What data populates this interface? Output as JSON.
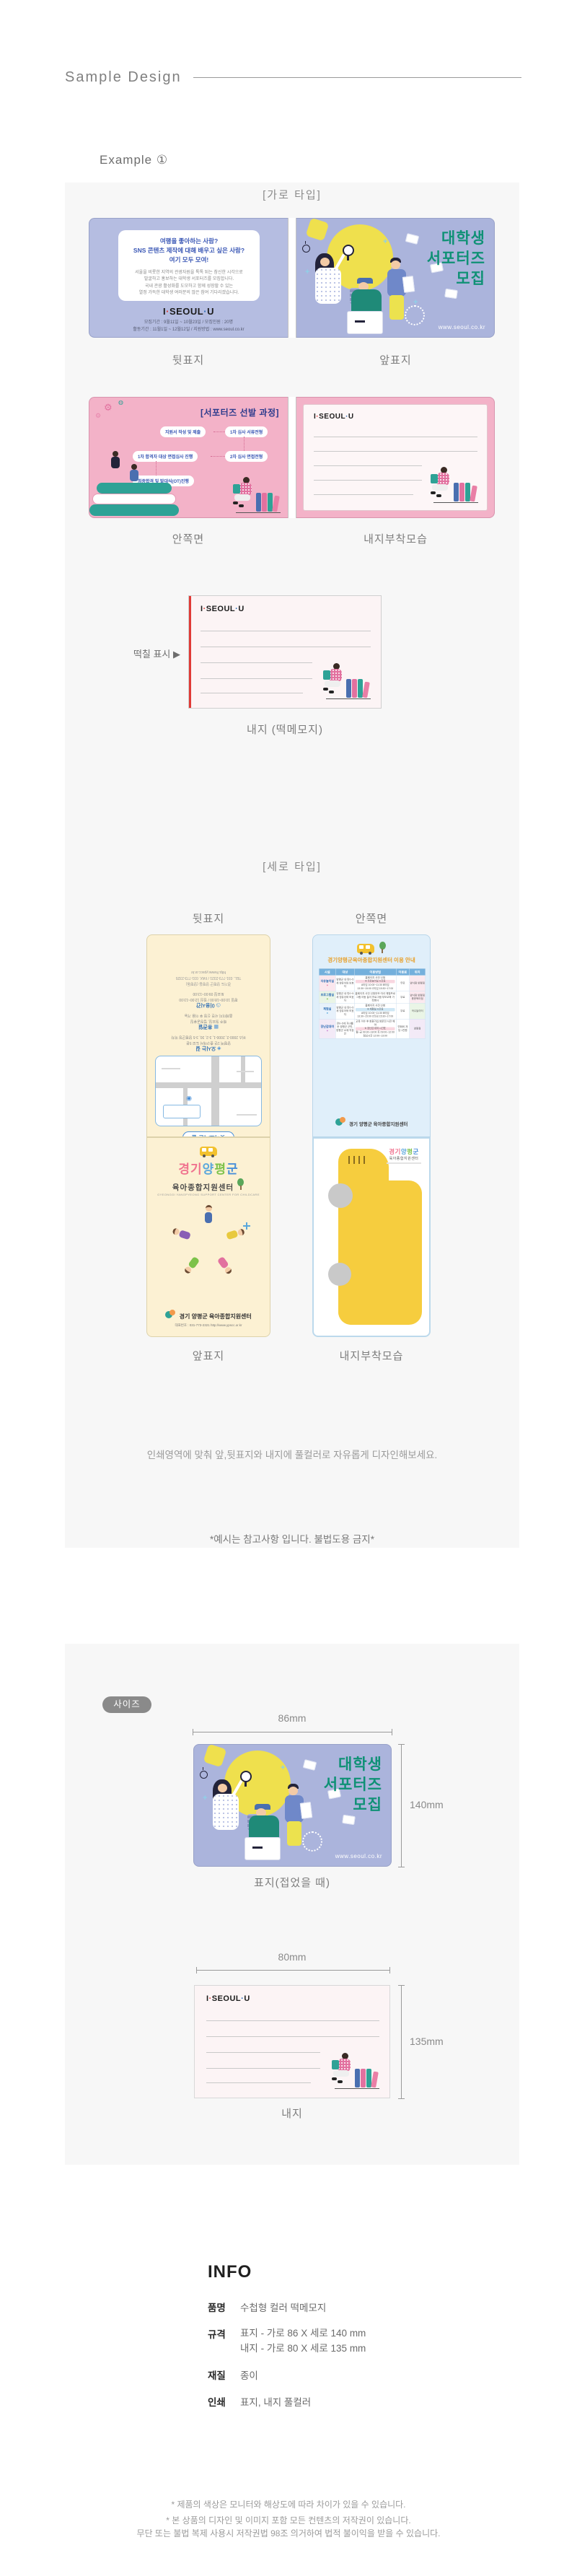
{
  "colors": {
    "panel": "#f7f7f7",
    "lavender-back": "#b5bde1",
    "lavender-front": "#abb4dc",
    "green-title": "#0f9175",
    "blue-heading": "#3a57b5",
    "navy-title": "#2b3a8c",
    "pink-card": "#f3b2c8",
    "pink-deep": "#e2719f",
    "cream-card": "#fcf1d3",
    "lightblue-card": "#e0effa",
    "table-header": "#74b0dc",
    "yellow-sticky": "#f6cd3e",
    "yellow-bulb": "#efe04d",
    "red-mark": "#e03a36",
    "orange-title": "#e8a029",
    "badge-gray": "#8a8a8a",
    "blue-dot": "#2b6cb5"
  },
  "header": {
    "title": "Sample Design"
  },
  "example": {
    "label": "Example ①"
  },
  "sections": {
    "horizontal_label": "[가로 타입]",
    "vertical_label": "[세로 타입]"
  },
  "captions": {
    "back_cover": "뒷표지",
    "front_cover": "앞표지",
    "inside": "안쪽면",
    "attached": "내지부착모습",
    "memo_note": "내지 (떡메모지)",
    "glue_mark": "떡칠 표시 ▶",
    "v_back_cover": "뒷표지",
    "v_inside": "안쪽면",
    "v_front_cover": "앞표지",
    "v_attached": "내지부착모습",
    "cover_folded": "표지(접었을 때)",
    "inner_sheet": "내지"
  },
  "seoul": {
    "logo_parts": {
      "i": "I",
      "seoul": "SEOUL",
      "u": "U"
    },
    "back_heading_lines": [
      "여행을 좋아하는 사람?",
      "SNS 콘텐츠 제작에 대해 배우고 싶은 사람?",
      "여기 모두 모여!"
    ],
    "back_body_lines": [
      "서울을 비롯한 지역의 관광자원을 톡톡 튀는 참신한 시각으로",
      "발굴하고 홍보하는 대학생 서포터즈를 모집합니다.",
      "국내 관광 활성화를 도모하고 함께 성장할 수 있는",
      "열정 가득한 대학생 여러분의 많은 참여 기다리겠습니다."
    ],
    "back_meta_lines": [
      "모집기간 : 9월11일 ~ 10월23일 / 모집인원 : 20명",
      "활동기간 : 11월1일 ~ 12월12일 / 지원방법 : www.seoul.co.kr"
    ],
    "front_title_lines": [
      "대학생",
      "서포터즈",
      "모집"
    ],
    "front_url": "www.seoul.co.kr",
    "process_title": "[서포터즈 선발 과정]",
    "process_steps": [
      "지원서 작성 및 제출",
      "1차 심사 서류전형",
      "1차 합격자 대상 면접심사 진행",
      "2차 심사 면접전형",
      "최종합격 및 발대식(OT)진행"
    ]
  },
  "yangpyeong": {
    "map_title": "찾아오시는 길",
    "guide_sections": [
      {
        "icon": "◈",
        "title": "오시는 길",
        "lines": [
          "양평역 1번 출구에서 도보 5분",
          "버스 2000-2, 2000-1, 3-2, 30, 3-5 양평군청 하차"
        ]
      },
      {
        "icon": "▦",
        "title": "휴관일",
        "lines": [
          "매주 월요일, 법정공휴일",
          "홈페이지 사전 신청 후 이용 가능"
        ]
      },
      {
        "icon": "◷",
        "title": "이용시간",
        "lines": [
          "평일 10:00~18:00 / 점심 12:00~13:00",
          "토요일 09:00~13:00"
        ]
      }
    ],
    "contact_lines": [
      "경기도 양평군 양평읍 (양평동)",
      "TEL. 031-773-2321 / FAX. 031-773-2325",
      "http://www.ypscc.or.kr"
    ],
    "title_parts": {
      "p1": "경기",
      "p2": "양",
      "p3": "평",
      "p4": "군"
    },
    "subtitle": "육아종합지원센터",
    "subtitle_en": "GYEONGGI YANGPYEONG SUPPORT CENTER FOR CHILDCARE",
    "logo_name": "경기 양평군 육아종합지원센터",
    "logo_contact": "대표번호 : 031-773-2321   http://www.ypscc.or.kr",
    "usage_title": "경기양평군육아종합지원센터 이용 안내",
    "usage_columns": [
      "시설",
      "대상",
      "이용방법",
      "이용료",
      "위치"
    ],
    "usage_rows": [
      {
        "facility": "자유놀이실",
        "target": "양평군 내 만0~5세 영유아와 보호자",
        "method_pre": "홈페이지 사전 신청",
        "method_hl": "※ 자유놀이실 시간표",
        "method_rest": "A타임 10:00~11:30 B타임 13:30~15:00 C타임 15:30~17:00",
        "fee": "무료",
        "location": "양서점 양평점"
      },
      {
        "facility": "프로그램실",
        "target": "양평군 내 만0~5세 영유아와 보호자",
        "method_pre": "홈페이지 사전 신청",
        "method_hl": "",
        "method_rest": "부모·자녀 체험프로그램 아동 놀이 프로그램 부모교육 가족행사",
        "fee": "무료",
        "location": "양서점 양평점 용문육아점"
      },
      {
        "facility": "체험실",
        "target": "양평군 내 만0~5세 영유아와 보호자",
        "method_pre": "홈페이지 사전 신청",
        "method_hl": "※ 체험실 시간표",
        "method_rest": "A타임 10:00~11:30 B타임 13:30~15:00 C타임 15:30~17:00",
        "fee": "무료",
        "location": "곡수놀이터"
      },
      {
        "facility": "장난감대여",
        "target": "만0~5세 자녀를 둔 양평군 군민, 양평군 소재 직장인",
        "method_pre": "교육 이수 후 회원가입 방문전 사전 예약",
        "method_hl": "※ 장난감 대여 시간표",
        "method_rest": "월~금 09:30~18:00 토 09:00~12:00 점심시간 12:00~13:00",
        "fee": "연회비 개당 1천원",
        "location": "양평점"
      }
    ]
  },
  "notes": {
    "design": "인쇄영역에 맞춰 앞,뒷표지와 내지에 풀컬러로 자유롭게 디자인해보세요.",
    "warning": "*예시는 참고사항 입니다. 불법도용 금지*"
  },
  "size": {
    "badge": "사이즈",
    "cover_width": "86mm",
    "cover_height": "140mm",
    "inner_width": "80mm",
    "inner_height": "135mm"
  },
  "info": {
    "heading": "INFO",
    "rows": [
      {
        "label": "품명",
        "value": "수첩형 컬러 떡메모지"
      },
      {
        "label": "규격",
        "value": "표지 - 가로 86 X 세로 140 mm",
        "value2": "내지 - 가로 80 X 세로 135 mm"
      },
      {
        "label": "재질",
        "value": "종이"
      },
      {
        "label": "인쇄",
        "value": "표지, 내지 풀컬러"
      }
    ]
  },
  "footer": {
    "line1": "* 제품의 색상은 모니터와 해상도에 따라 차이가 있을 수 있습니다.",
    "line2": "* 본 상품의 디자인 및 이미지 포함 모든 컨텐츠의 저작권이 있습니다.",
    "line3": "무단 또는 불법 복제 사용시 저작권법 98조 의거하여 법적 불이익을 받을 수 있습니다."
  }
}
